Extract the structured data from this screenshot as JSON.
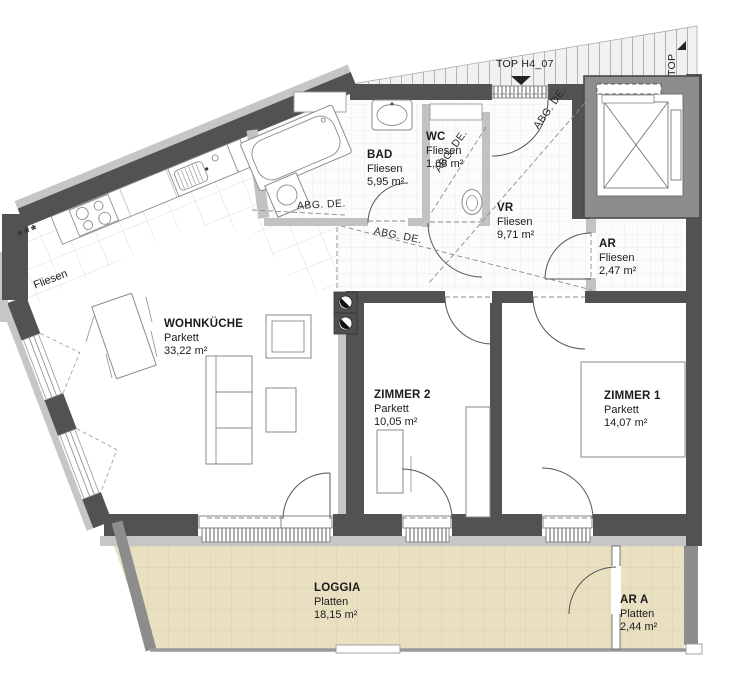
{
  "drawing": {
    "unit_label": "TOP H4_07",
    "corridor_label": "TOP",
    "ceiling_note": "ABG. DE.",
    "kitchen_floor_note": "Fliesen",
    "freezer_symbol": "***"
  },
  "rooms": [
    {
      "key": "wohnkueche",
      "name": "WOHNKÜCHE",
      "floor": "Parkett",
      "area": "33,22 m²"
    },
    {
      "key": "bad",
      "name": "BAD",
      "floor": "Fliesen",
      "area": "5,95 m²"
    },
    {
      "key": "wc",
      "name": "WC",
      "floor": "Fliesen",
      "area": "1,68 m²"
    },
    {
      "key": "vr",
      "name": "VR",
      "floor": "Fliesen",
      "area": "9,71 m²"
    },
    {
      "key": "ar",
      "name": "AR",
      "floor": "Fliesen",
      "area": "2,47 m²"
    },
    {
      "key": "zimmer2",
      "name": "ZIMMER 2",
      "floor": "Parkett",
      "area": "10,05 m²"
    },
    {
      "key": "zimmer1",
      "name": "ZIMMER 1",
      "floor": "Parkett",
      "area": "14,07 m²"
    },
    {
      "key": "loggia",
      "name": "LOGGIA",
      "floor": "Platten",
      "area": "18,15 m²"
    },
    {
      "key": "ara",
      "name": "AR A",
      "floor": "Platten",
      "area": "2,44 m²"
    }
  ],
  "colors": {
    "wall_dark": "#525252",
    "wall_light": "#c6c6c6",
    "wall_mid": "#8d8d8d",
    "loggia_fill": "#e9e0c2",
    "corridor_fill": "#f1f1f1",
    "text": "#1b1b1b"
  }
}
